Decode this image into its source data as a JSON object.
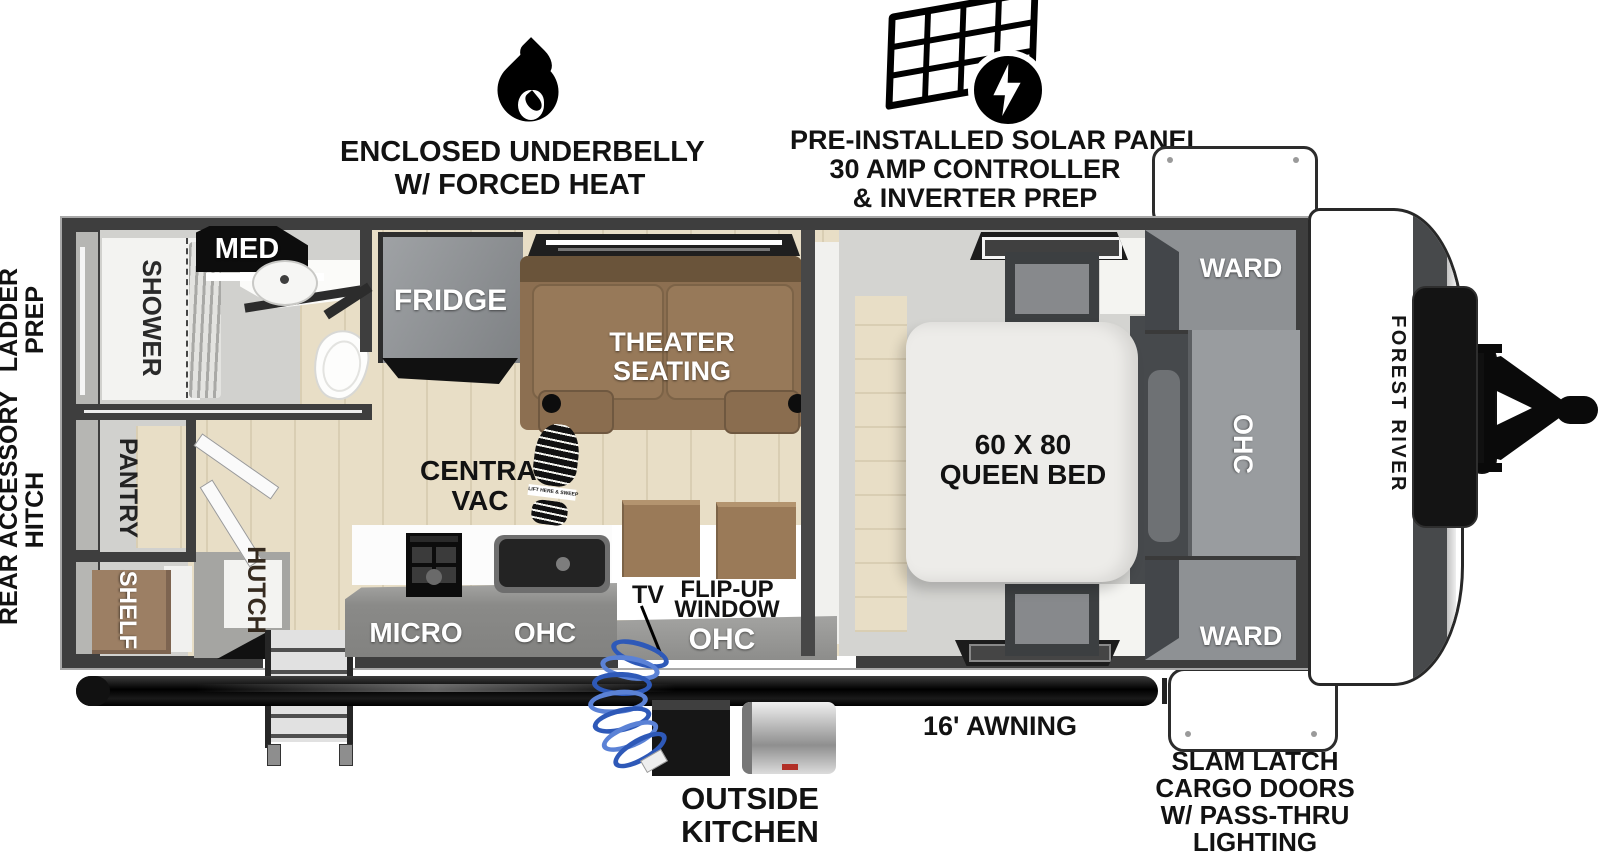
{
  "top": {
    "underbelly": [
      "ENCLOSED UNDERBELLY",
      "W/ FORCED HEAT"
    ],
    "solar": [
      "PRE-INSTALLED SOLAR PANEL",
      "30 AMP CONTROLLER",
      "& INVERTER PREP"
    ]
  },
  "left_margin": {
    "ladder_prep": [
      "LADDER",
      "PREP"
    ],
    "rear_hitch": [
      "REAR ACCESSORY",
      "HITCH"
    ]
  },
  "rooms": {
    "med": "MED",
    "shower": "SHOWER",
    "pantry": "PANTRY",
    "shelf": "SHELF",
    "hutch": "HUTCH",
    "fridge": "FRIDGE",
    "theater": [
      "THEATER",
      "SEATING"
    ],
    "central_vac": [
      "CENTRAL",
      "VAC"
    ],
    "boot_text": "LIFT HERE & SWEEP",
    "micro": "MICRO",
    "ohc_kitchen": "OHC",
    "tv": "TV",
    "flip_up": [
      "FLIP-UP",
      "WINDOW"
    ],
    "ohc_entry": "OHC",
    "bed": [
      "60 X 80",
      "QUEEN BED"
    ],
    "ward_top": "WARD",
    "ward_bottom": "WARD",
    "ohc_bedroom": "OHC",
    "brand": "FOREST RIVER"
  },
  "bottom": {
    "outside_kitchen": [
      "OUTSIDE",
      "KITCHEN"
    ],
    "awning": "16' AWNING",
    "slam_latch": [
      "SLAM LATCH",
      "CARGO DOORS",
      "W/ PASS-THRU",
      "LIGHTING"
    ]
  },
  "colors": {
    "wall": "#3e3e3e",
    "wood_floor": "#e8dec6",
    "tile_floor": "#d1d1ce",
    "cabinet_gray": "#8e9194",
    "sofa_brown": "#8c6f51",
    "hose_blue": "#2e59b8"
  }
}
